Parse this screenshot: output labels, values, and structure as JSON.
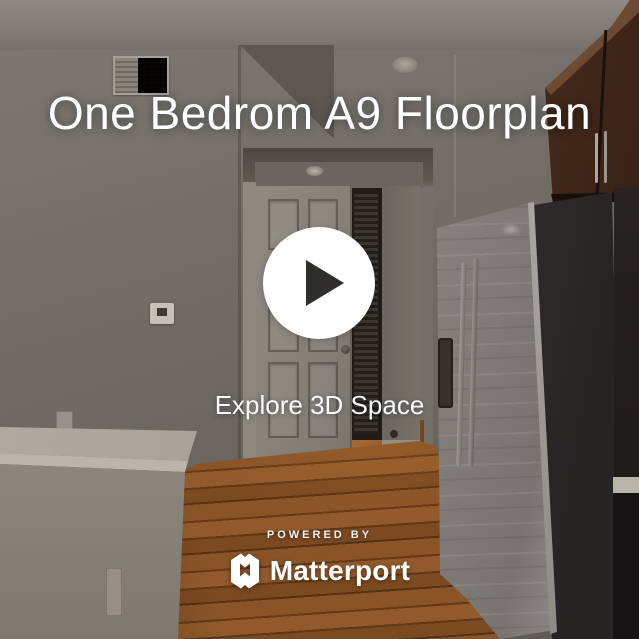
{
  "viewer": {
    "title": "One Bedrom A9 Floorplan",
    "play": {
      "icon": "play-icon"
    },
    "explore_label": "Explore 3D Space",
    "footer": {
      "powered_by": "POWERED BY",
      "brand": "Matterport",
      "brand_icon": "matterport-logo-icon"
    },
    "colors": {
      "title_text": "#ffffff",
      "play_circle": "#ffffff",
      "play_triangle": "#2f2e2d",
      "footer_text": "#ffffff",
      "wood_floor": "#8a5427",
      "wall": "#706b65"
    }
  }
}
